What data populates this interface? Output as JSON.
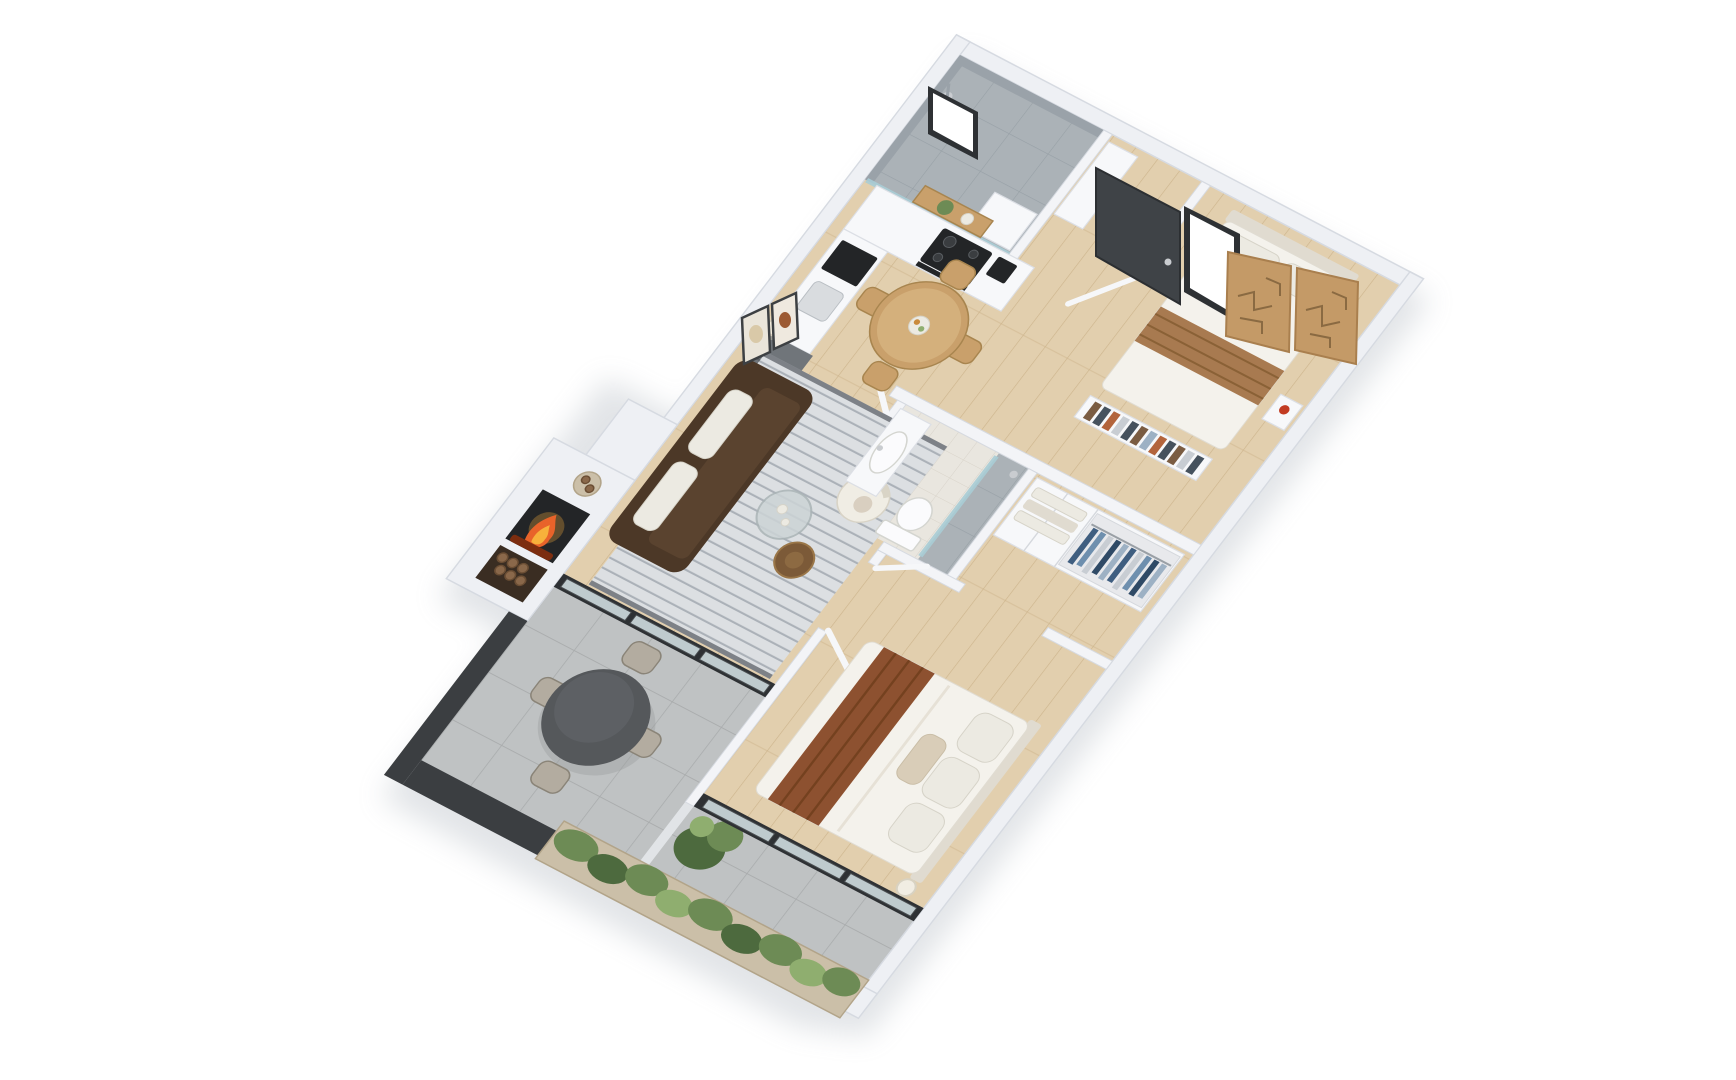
{
  "scene": {
    "description": "Photorealistic 3D isometric rendering of a two-bedroom apartment floor plan viewed from above, rotated roughly 28 degrees, on a plain white background",
    "projection": "top-down isometric 3D cutaway",
    "background": "#ffffff"
  },
  "rooms": [
    {
      "name": "Shower Room",
      "furniture": [
        "concrete-walled walk-in shower",
        "glass partition",
        "shower head",
        "small white vanity unit",
        "black-framed slot window"
      ]
    },
    {
      "name": "Kitchen",
      "furniture": [
        "L-shaped white cabinetry",
        "black induction cooktop with 4 burners",
        "black built-in oven",
        "built-in microwave",
        "stainless two-tone fridge",
        "black base cabinet",
        "coffee machine",
        "open timber shelf with potted plant",
        "counter sink"
      ]
    },
    {
      "name": "Entry Hall",
      "furniture": [
        "dark charcoal entry door",
        "tall white storage cabinet"
      ]
    },
    {
      "name": "Bedroom 2",
      "furniture": [
        "double bed with white linen and tan striped runner",
        "two pillows",
        "headboard",
        "low bookshelf with books",
        "wall shelf with red vase",
        "two tan abstract art panels",
        "black-framed window",
        "open white door"
      ]
    },
    {
      "name": "Bathroom",
      "furniture": [
        "white vanity with basin",
        "mirror",
        "toilet",
        "tiled shower zone with glass screen",
        "open white door"
      ]
    },
    {
      "name": "Walk-in Wardrobe",
      "furniture": [
        "white wardrobe cabinets",
        "open hanging rail with blue and denim clothes",
        "folded linen shelves"
      ]
    },
    {
      "name": "Bedroom 1 (Master)",
      "furniture": [
        "queen bed with white duvet and rust throw",
        "stack of pillows",
        "sphere bedside lamp",
        "double doors opening from living room",
        "sliding glass door to terrace"
      ]
    },
    {
      "name": "Living Room",
      "furniture": [
        "dark brown fabric sofa with light cushions",
        "striped grey rug",
        "round timber side table",
        "round glass tray table with bottles",
        "white boucle barrel chair",
        "floor lamp with glowing shade",
        "two framed artworks on wall"
      ]
    },
    {
      "name": "Dining Area",
      "furniture": [
        "round timber dining table",
        "four timber spindle chairs",
        "fruit bowl centrepiece"
      ]
    },
    {
      "name": "Fireplace Nook",
      "furniture": [
        "white chimney block",
        "burning firebox",
        "firewood storage niche",
        "log basket on ledge"
      ]
    },
    {
      "name": "Terrace / Patio",
      "furniture": [
        "large grey stone tiles",
        "dark round outdoor table",
        "four rope outdoor chairs with black legs",
        "charcoal perimeter wall",
        "timber planter boxes with green hedge",
        "tall leafy plant",
        "black-framed sliding doors"
      ]
    }
  ],
  "palette": {
    "background": "#ffffff",
    "wall": "#eef0f4",
    "wallInner": "#f3f4f7",
    "wallEdge": "#d6dae1",
    "concreteWall": "#9aa2a9",
    "woodFloor": "#e2cfae",
    "woodPlank": "#cdb48c",
    "tileFloor": "#bfc2c3",
    "tileLine": "#a8abac",
    "bathFloor": "#e9e6df",
    "bathTile": "#d8d3c9",
    "concreteFloor": "#abb2b7",
    "concreteLine": "#97a0a6",
    "glass": "#a9ccd5",
    "frameBlack": "#2e3134",
    "doorDark": "#3f4347",
    "sofaDark": "#4c3827",
    "sofaSeat": "#5a432f",
    "cushionLight": "#eceae2",
    "rug": "#dcdfe2",
    "rugStripe": "#abb1b8",
    "rugEdge": "#5d6168",
    "accentChair": "#f0ede4",
    "woodFurniture": "#c9a06b",
    "woodFurnitureEdge": "#a8854f",
    "bedLinen": "#f4f2ec",
    "linenShade": "#e0dbd0",
    "throwRust": "#8d5130",
    "throwDark": "#74411f",
    "runnerTan": "#a87a50",
    "runnerStripe": "#8a6136",
    "artTan": "#c49a67",
    "artLine": "#8a6a42",
    "applianceDark": "#232527",
    "fridgeSteel": "#70757a",
    "steelLight": "#c9ccd0",
    "white": "#f7f8fa",
    "whiteEdge": "#dcdfe5",
    "fireOrange": "#e8632a",
    "fireYellow": "#f7b13b",
    "ember": "#7c2d0f",
    "logBrown": "#8a684a",
    "logEdge": "#6b4e34",
    "plantGreen": "#6d8b55",
    "plantGreenDark": "#4d6a3e",
    "plantLight": "#8fae6f",
    "charcoalWall": "#3b3e41",
    "planterWood": "#cbbfa8",
    "planterEdge": "#b2a489",
    "outdoorTable": "#55585b",
    "outdoorChair": "#b3aca0",
    "outdoorChairEdge": "#8a8478",
    "toiletWhite": "#fbfbfd",
    "clothes1": "#3f5e80",
    "clothes2": "#6e8fae",
    "clothes3": "#c8cdd3",
    "clothes4": "#2f4a66",
    "clothes5": "#9db1c4",
    "book1": "#7a5c42",
    "book2": "#46525e",
    "book3": "#b3643c",
    "vaseRed": "#c23b22"
  }
}
